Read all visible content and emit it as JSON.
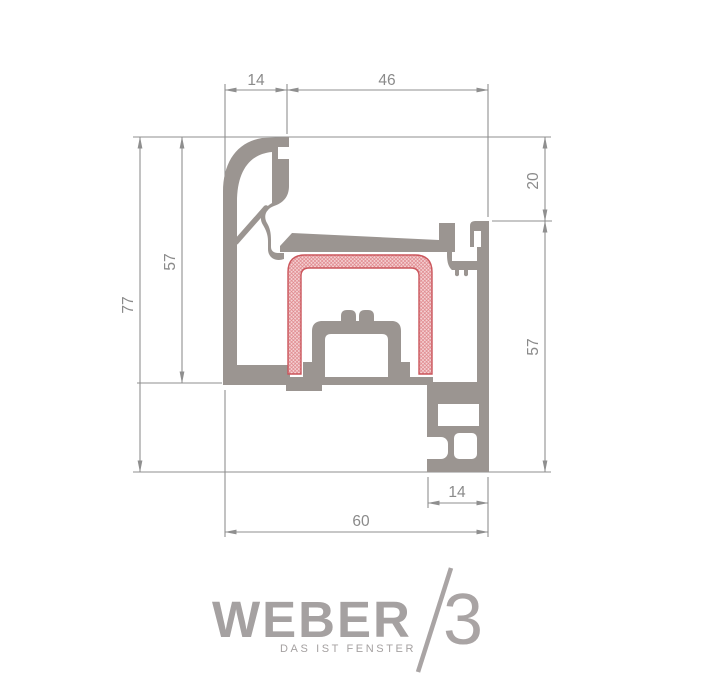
{
  "drawing": {
    "title": "window-profile-cross-section",
    "dimensions": {
      "top_left": "14",
      "top_right": "46",
      "right_upper": "20",
      "right_lower": "57",
      "left_outer": "77",
      "left_inner": "57",
      "bottom_inner": "14",
      "bottom_total": "60"
    },
    "colors": {
      "profile_gray": "#9b9591",
      "dimension_gray": "#8f8f8f",
      "label_gray": "#8a8a8a",
      "insulation_outline": "#cb565c",
      "insulation_fill": "#f5d3d5",
      "insulation_hatch": "#dd8186",
      "logo_gray": "#a5a1a1"
    }
  },
  "logo": {
    "brand": "WEBER",
    "series": "3",
    "tagline": "DAS IST FENSTER"
  }
}
